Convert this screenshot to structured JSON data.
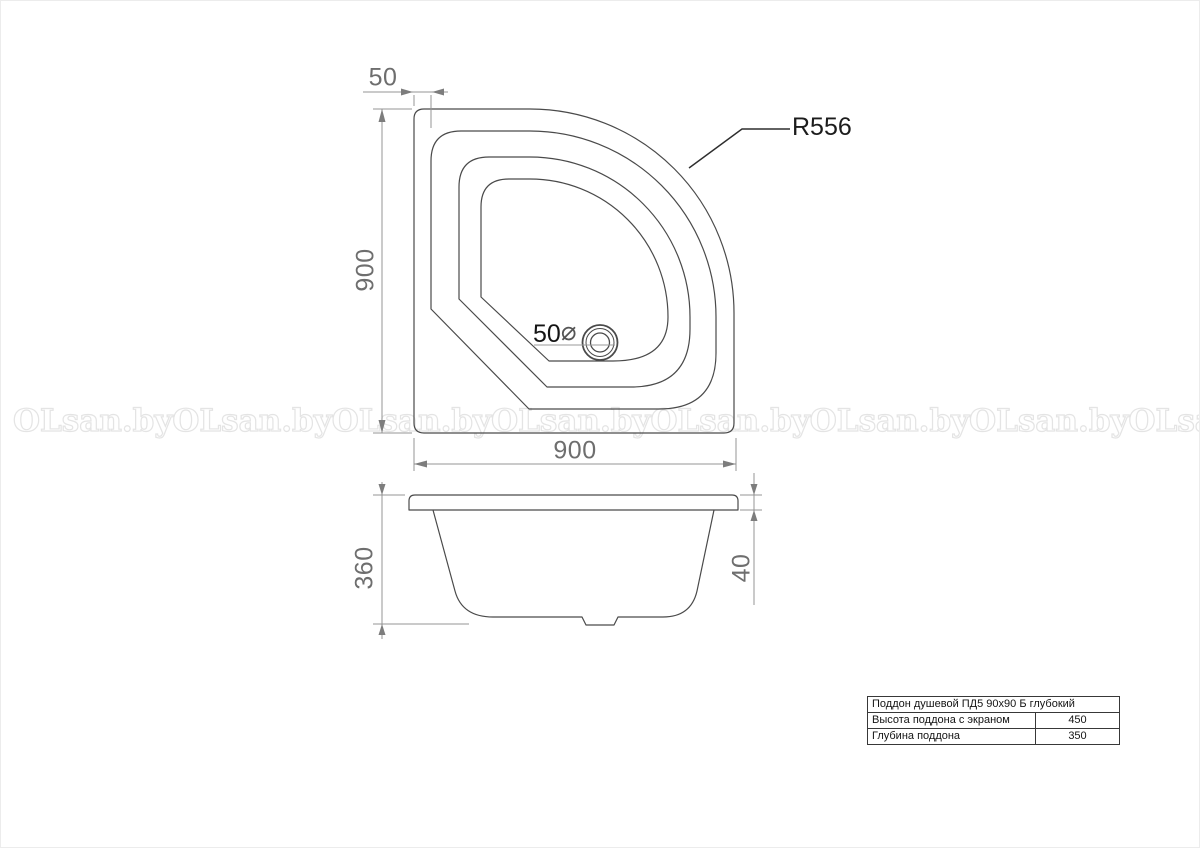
{
  "drawing": {
    "plan_view": {
      "dim_top_offset": "50",
      "dim_left_height": "900",
      "dim_bottom_width": "900",
      "radius_callout": "R556",
      "drain_value": "50",
      "drain_diameter_symbol": "⌀"
    },
    "side_view": {
      "dim_left_depth": "360",
      "dim_right_rim": "40"
    }
  },
  "watermark": {
    "text": "OLsan.by",
    "count": 8
  },
  "spec_table": {
    "title": "Поддон душевой ПД5 90x90 Б глубокий",
    "rows": [
      {
        "label": "Высота поддона с экраном",
        "value": "450"
      },
      {
        "label": "Глубина поддона",
        "value": "350"
      }
    ]
  },
  "colors": {
    "outline": "#4a4a4a",
    "dimension_line": "#949494",
    "dimension_text": "#6e6e6e",
    "callout_text": "#1c1c1c",
    "watermark": "#e4e4e4",
    "table_border": "#383838"
  }
}
